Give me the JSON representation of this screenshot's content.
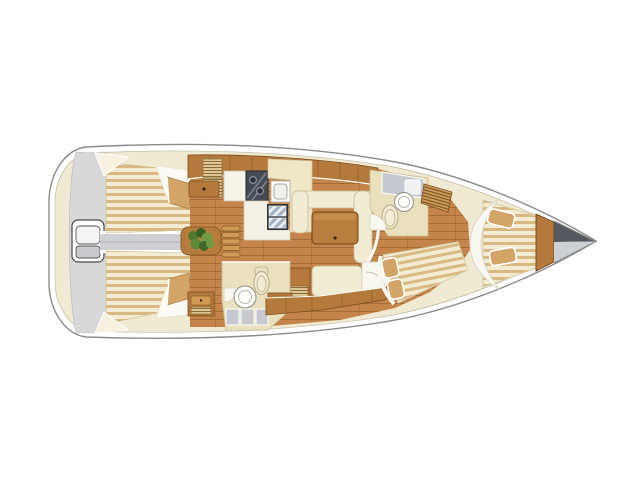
{
  "diagram": {
    "type": "boat-floor-plan",
    "subject": "sailing-yacht-interior-layout-top-view",
    "bow_direction": "right",
    "stern_direction": "left"
  },
  "features": [
    "hull",
    "swim-platform",
    "transom-door",
    "cockpit-sole",
    "cockpit-bench-port",
    "cockpit-bench-starboard",
    "helm-seat-port",
    "helm-seat-starboard",
    "cockpit-table",
    "cockpit-table-plant",
    "companionway-steps",
    "cabin-floor",
    "galley-cabinets",
    "galley-louver-locker",
    "galley-drawer",
    "galley-counter",
    "galley-stove",
    "galley-sink",
    "galley-refrigerator",
    "galley-worktop",
    "salon-settee-port",
    "salon-table",
    "salon-settee-starboard",
    "salon-cabinet-starboard",
    "aft-head-room",
    "aft-head-door",
    "aft-head-sink",
    "aft-head-toilet",
    "aft-head-shower-floor",
    "aft-head-locker",
    "starboard-locker-band",
    "forward-head-room",
    "forward-head-shower-floor",
    "forward-head-sink",
    "forward-head-toilet",
    "forward-head-door",
    "forward-cabin-shelf",
    "forward-berth",
    "v-berth",
    "v-berth-headboard",
    "bow-bulkhead",
    "anchor-locker"
  ],
  "colors": {
    "hull_fill": "#ffffff",
    "hull_outline": "#8b8b8b",
    "deck": "#f1ead3",
    "platform_gray": "#d7d8da",
    "sole_gray": "#cfd0d3",
    "shower_gray": "#c6cad0",
    "cushion_cream": "#f1ecd4",
    "cushion_trim": "#c8bc96",
    "pillow_tan": "#d2a465",
    "furniture_wood": "#b5793c",
    "furniture_wood_dark": "#7a4e1f",
    "table_wood": "#b87e3e",
    "floor_base": "#c5854a",
    "floor_line": "#a36c35",
    "stove_dark": "#454b54",
    "fridge_frame": "#30353b",
    "fridge_stripe": "#9fb0c0",
    "fixture_white": "#fdfdfb",
    "head_floor": "#eae0bd",
    "plant_green": "#4e7a2e",
    "plant_green_light": "#6d9c44",
    "bow_dark": "#55585e",
    "bow_light": "#cdd0d4"
  }
}
